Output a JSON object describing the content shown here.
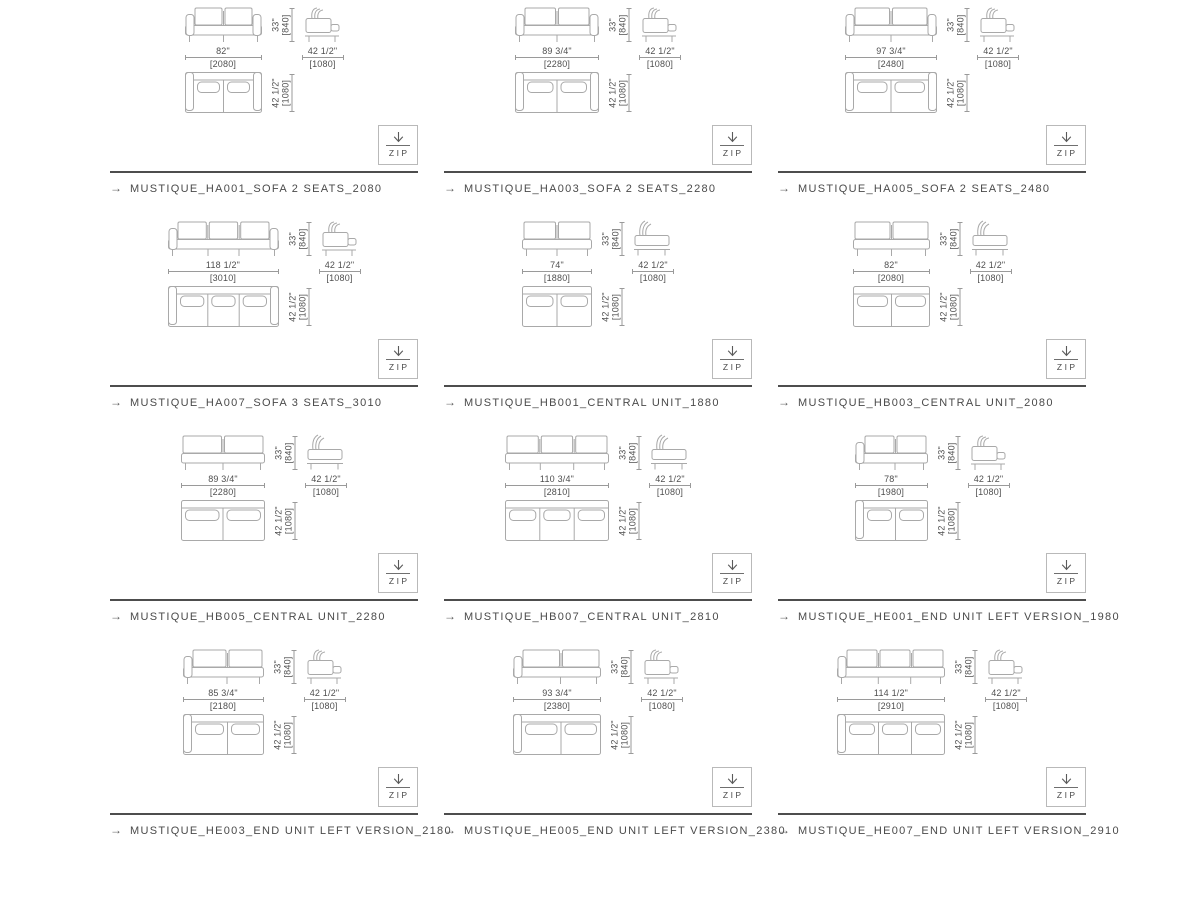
{
  "page": {
    "background": "#ffffff"
  },
  "colors": {
    "drawing_line": "#a9a9a9",
    "dimension_line": "#9a9a9a",
    "dimension_text": "#4f4f4f",
    "name_text": "#4a4a4a",
    "separator": "#4d4d4d",
    "zip_border": "#b9b9b9"
  },
  "glyphs": {
    "item_arrow": "→",
    "zip_icon": "download-arrow-icon"
  },
  "zip_button": {
    "label": "ZIP"
  },
  "shared_dimensions": {
    "height_in": "33\"",
    "height_mm": "[840]",
    "depth_in": "42 1/2\"",
    "depth_mm": "[1080]"
  },
  "products": [
    {
      "name": "MUSTIQUE_HA001_SOFA 2 SEATS_2080",
      "width_in": "82\"",
      "width_mm": "[2080]",
      "unit_type": "sofa",
      "seats": 2,
      "width_mm_value": 2080
    },
    {
      "name": "MUSTIQUE_HA003_SOFA 2 SEATS_2280",
      "width_in": "89 3/4\"",
      "width_mm": "[2280]",
      "unit_type": "sofa",
      "seats": 2,
      "width_mm_value": 2280
    },
    {
      "name": "MUSTIQUE_HA005_SOFA 2 SEATS_2480",
      "width_in": "97 3/4\"",
      "width_mm": "[2480]",
      "unit_type": "sofa",
      "seats": 2,
      "width_mm_value": 2480
    },
    {
      "name": "MUSTIQUE_HA007_SOFA 3 SEATS_3010",
      "width_in": "118 1/2\"",
      "width_mm": "[3010]",
      "unit_type": "sofa",
      "seats": 3,
      "width_mm_value": 3010
    },
    {
      "name": "MUSTIQUE_HB001_CENTRAL UNIT_1880",
      "width_in": "74\"",
      "width_mm": "[1880]",
      "unit_type": "central",
      "seats": 2,
      "width_mm_value": 1880
    },
    {
      "name": "MUSTIQUE_HB003_CENTRAL UNIT_2080",
      "width_in": "82\"",
      "width_mm": "[2080]",
      "unit_type": "central",
      "seats": 2,
      "width_mm_value": 2080
    },
    {
      "name": "MUSTIQUE_HB005_CENTRAL UNIT_2280",
      "width_in": "89 3/4\"",
      "width_mm": "[2280]",
      "unit_type": "central",
      "seats": 2,
      "width_mm_value": 2280
    },
    {
      "name": "MUSTIQUE_HB007_CENTRAL UNIT_2810",
      "width_in": "110 3/4\"",
      "width_mm": "[2810]",
      "unit_type": "central",
      "seats": 3,
      "width_mm_value": 2810
    },
    {
      "name": "MUSTIQUE_HE001_END UNIT LEFT VERSION_1980",
      "width_in": "78\"",
      "width_mm": "[1980]",
      "unit_type": "end-left",
      "seats": 2,
      "width_mm_value": 1980
    },
    {
      "name": "MUSTIQUE_HE003_END UNIT LEFT VERSION_2180",
      "width_in": "85 3/4\"",
      "width_mm": "[2180]",
      "unit_type": "end-left",
      "seats": 2,
      "width_mm_value": 2180
    },
    {
      "name": "MUSTIQUE_HE005_END UNIT LEFT VERSION_2380",
      "width_in": "93 3/4\"",
      "width_mm": "[2380]",
      "unit_type": "end-left",
      "seats": 2,
      "width_mm_value": 2380
    },
    {
      "name": "MUSTIQUE_HE007_END UNIT LEFT VERSION_2910",
      "width_in": "114 1/2\"",
      "width_mm": "[2910]",
      "unit_type": "end-left",
      "seats": 3,
      "width_mm_value": 2910
    }
  ]
}
